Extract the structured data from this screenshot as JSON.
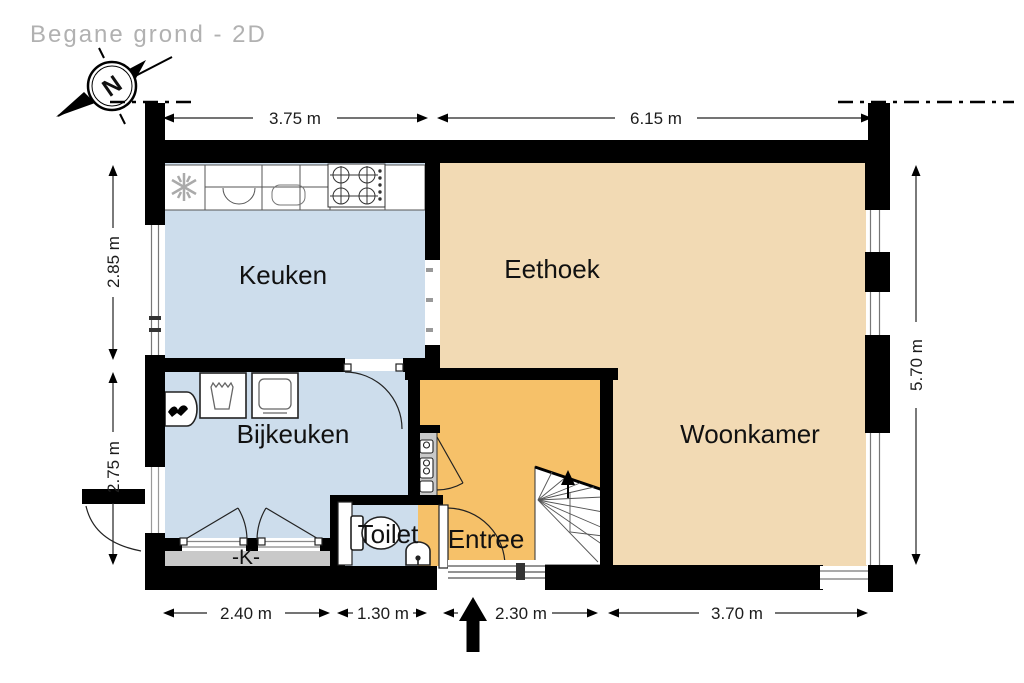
{
  "title": "Begane grond - 2D",
  "compass": {
    "label": "N"
  },
  "rooms": {
    "keuken": {
      "label": "Keuken"
    },
    "eethoek": {
      "label": "Eethoek"
    },
    "woonkamer": {
      "label": "Woonkamer"
    },
    "bijkeuken": {
      "label": "Bijkeuken"
    },
    "toilet": {
      "label": "Toilet"
    },
    "entree": {
      "label": "Entree"
    },
    "closet": {
      "label": "-K-"
    }
  },
  "dimensions": {
    "top": [
      "3.75 m",
      "6.15 m"
    ],
    "left": [
      "2.85 m",
      "2.75 m"
    ],
    "right": [
      "5.70 m"
    ],
    "bottom": [
      "2.40 m",
      "1.30 m",
      "2.30 m",
      "3.70 m"
    ]
  },
  "colors": {
    "cold_rooms": "#cdddec",
    "living_rooms": "#f2dab4",
    "entry": "#f6c169",
    "walls": "#000000",
    "paving": "#c9c9c9",
    "title_text": "#b1b1b1"
  }
}
